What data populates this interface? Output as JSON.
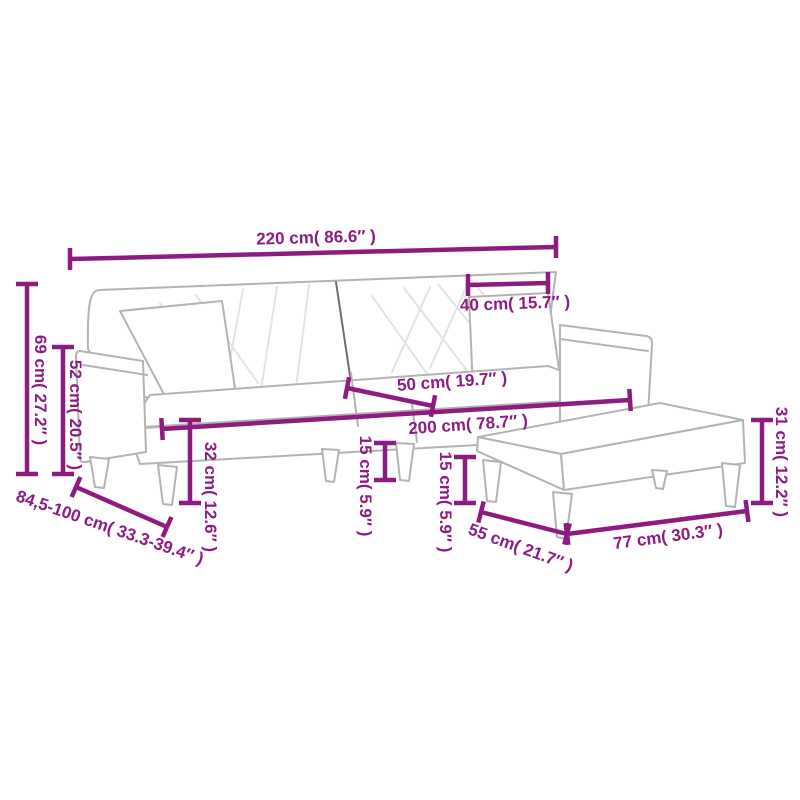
{
  "title": "Sofa bed with two pillows and footstool - dimension diagram",
  "colors": {
    "dimension": "#8E1C80",
    "furniture_outline": "#b3b3b3",
    "furniture_accent": "#c9c9c9",
    "split_line": "#6f6f6f",
    "stitch_line": "#e3e3e3",
    "background": "#ffffff"
  },
  "dimensions": {
    "sofa_width": {
      "label": "220 cm( 86.6″ )"
    },
    "pillow_width": {
      "label": "40 cm( 15.7″ )"
    },
    "back_height": {
      "label": "69 cm( 27.2″ )"
    },
    "arm_height": {
      "label": "52 cm( 20.5″ )"
    },
    "depth_range": {
      "label": "84,5-100 cm( 33.3-39.4″ )"
    },
    "seat_depth": {
      "label": "50 cm( 19.7″ )"
    },
    "seat_width": {
      "label": "200 cm( 78.7″ )"
    },
    "seat_height": {
      "label": "32 cm( 12.6″ )"
    },
    "sofa_leg_height": {
      "label": "15 cm( 5.9″ )"
    },
    "stool_leg_height": {
      "label": "15 cm( 5.9″ )"
    },
    "stool_height": {
      "label": "31 cm( 12.2″ )"
    },
    "stool_depth": {
      "label": "55 cm( 21.7″ )"
    },
    "stool_width": {
      "label": "77 cm( 30.3″ )"
    }
  }
}
